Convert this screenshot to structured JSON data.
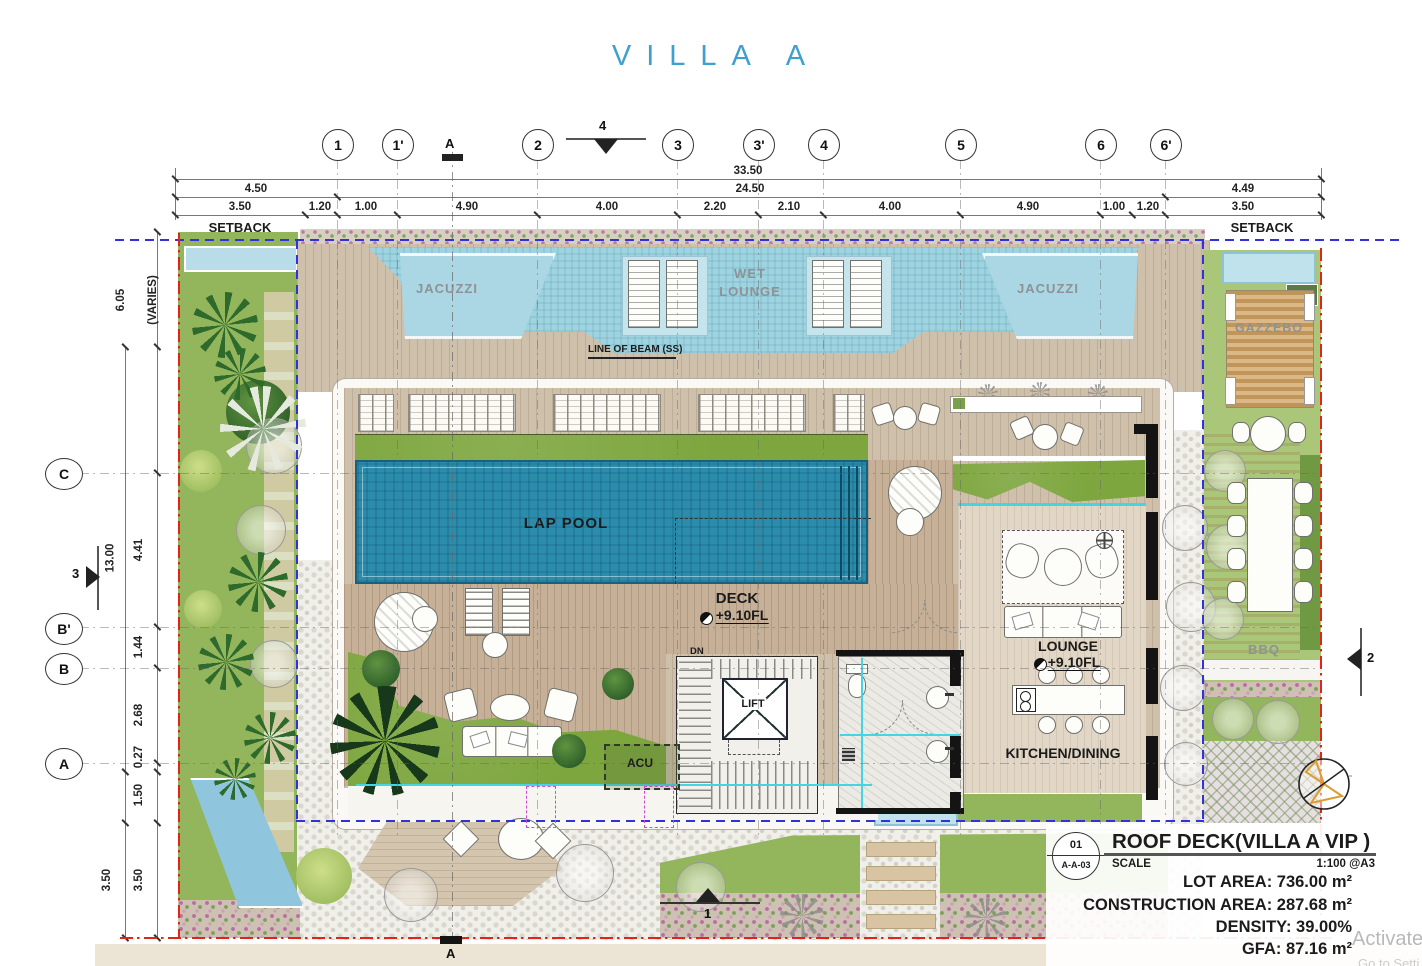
{
  "title": "VILLA A",
  "colors": {
    "title_blue": "#3FA0CD",
    "lap_pool_blue": "#2B8CAB",
    "wet_deck_blue": "#9ED3E0",
    "deck_wood": "#CFC0AB",
    "grass_green": "#7DA63E",
    "property_line_red": "#E02418",
    "setback_line_blue": "#3232D8",
    "revision_magenta": "#D348D8"
  },
  "grid": {
    "top": [
      {
        "label": "1"
      },
      {
        "label": "1'"
      },
      {
        "label": "2"
      },
      {
        "label": "3"
      },
      {
        "label": "3'"
      },
      {
        "label": "4"
      },
      {
        "label": "5"
      },
      {
        "label": "6"
      },
      {
        "label": "6'"
      }
    ],
    "left": [
      {
        "label": "C"
      },
      {
        "label": "B'"
      },
      {
        "label": "B"
      },
      {
        "label": "A"
      }
    ]
  },
  "sections": {
    "top_a": "A",
    "top_4": "4",
    "left_3": "3",
    "right_2": "2",
    "bottom_1": "1",
    "bottom_a": "A"
  },
  "dimensions": {
    "total": "33.50",
    "row2": [
      "4.50",
      "24.50",
      "4.49"
    ],
    "row3": [
      "3.50",
      "1.20",
      "1.00",
      "4.90",
      "4.00",
      "2.20",
      "2.10",
      "4.00",
      "4.90",
      "1.00",
      "1.20",
      "3.50"
    ],
    "left": {
      "varies_value": "6.05",
      "varies_note": "(VARIES)",
      "c_to_b1": "4.41",
      "vertical_total": "13.00",
      "b1_to_b": "1.44",
      "b_to_a": "2.68",
      "a_offset": "0.27",
      "a_to_edge": "1.50",
      "bottom_setback_inner": "3.50",
      "bottom_setback_outer": "3.50"
    }
  },
  "site": {
    "setback_left": "SETBACK",
    "setback_right": "SETBACK",
    "line_of_beam": "LINE OF BEAM (SS)"
  },
  "rooms": {
    "jacuzzi_left": "JACUZZI",
    "jacuzzi_right": "JACUZZI",
    "wet_lounge_line1": "WET",
    "wet_lounge_line2": "LOUNGE",
    "lap_pool": "LAP POOL",
    "deck": "DECK",
    "deck_level": "+9.10FL",
    "dn": "DN",
    "lift": "LIFT",
    "acu": "ACU",
    "lounge": "LOUNGE",
    "lounge_level": "+9.10FL",
    "kitchen_dining": "KITCHEN/DINING",
    "gazzebo": "GAZZEBO",
    "bbq": "BBQ"
  },
  "title_block": {
    "detail_number": "01",
    "sheet_ref": "A-A-03",
    "drawing_title": "ROOF DECK(VILLA A VIP )",
    "scale_label": "SCALE",
    "scale_value": "1:100 @A3",
    "lot_area": "LOT AREA: 736.00 m²",
    "construction_area": "CONSTRUCTION AREA: 287.68  m²",
    "density": "DENSITY: 39.00%",
    "gfa": "GFA: 87.16  m²"
  },
  "watermark": {
    "line1": "Activate",
    "line2": "Go to Setti"
  }
}
